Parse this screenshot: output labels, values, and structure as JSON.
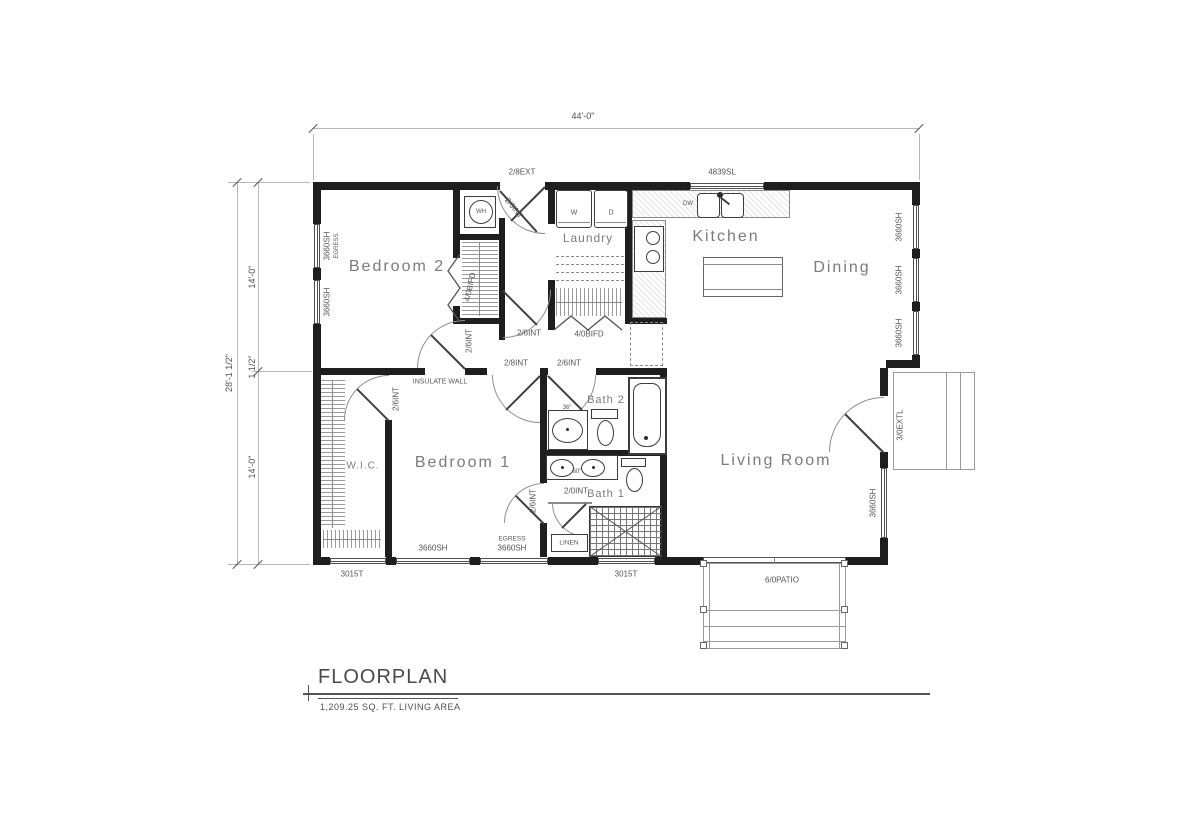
{
  "title_block": {
    "title": "FLOORPLAN",
    "subtitle": "1,209.25 SQ. FT. LIVING AREA"
  },
  "dimensions": {
    "overall_width": "44'-0\"",
    "overall_depth": "28'-1 1/2\"",
    "upper_depth": "14'-0\"",
    "wall_thickness": "1 1/2\"",
    "lower_depth": "14'-0\""
  },
  "rooms": {
    "bedroom2": "Bedroom 2",
    "bedroom1": "Bedroom 1",
    "wic": "W.I.C.",
    "laundry": "Laundry",
    "kitchen": "Kitchen",
    "dining": "Dining",
    "living": "Living Room",
    "bath1": "Bath 1",
    "bath2": "Bath 2"
  },
  "fixtures": {
    "washer": "W",
    "dryer": "D",
    "water_heater": "WH",
    "dishwasher": "DW",
    "linen": "LINEN",
    "bath2_vanity_width": "36\"",
    "bath1_vanity_width": "60\""
  },
  "annotations": [
    {
      "t": "2/8EXT",
      "x": 522,
      "y": 172
    },
    {
      "t": "4839SL",
      "x": 722,
      "y": 172
    },
    {
      "t": "2/6INT",
      "x": 514,
      "y": 208,
      "r": 52
    },
    {
      "t": "3660SH",
      "x": 327,
      "y": 246,
      "r": -90
    },
    {
      "t": "EGRESS",
      "x": 337,
      "y": 246,
      "r": -90,
      "s": 6
    },
    {
      "t": "3660SH",
      "x": 327,
      "y": 302,
      "r": -90
    },
    {
      "t": "4/0BIFD",
      "x": 470,
      "y": 287,
      "r": -78
    },
    {
      "t": "2/6INT",
      "x": 469,
      "y": 341,
      "r": -90
    },
    {
      "t": "2/6INT",
      "x": 529,
      "y": 333
    },
    {
      "t": "4/0BIFD",
      "x": 589,
      "y": 334
    },
    {
      "t": "2/8INT",
      "x": 516,
      "y": 363
    },
    {
      "t": "2/6INT",
      "x": 569,
      "y": 363
    },
    {
      "t": "INSULATE WALL",
      "x": 440,
      "y": 382,
      "s": 7
    },
    {
      "t": "2/6INT",
      "x": 396,
      "y": 399,
      "r": -90
    },
    {
      "t": "2/6INT",
      "x": 533,
      "y": 501,
      "r": -90
    },
    {
      "t": "2/0INT",
      "x": 576,
      "y": 491
    },
    {
      "t": "EGRESS",
      "x": 512,
      "y": 539,
      "s": 6.5
    },
    {
      "t": "3660SH",
      "x": 512,
      "y": 548
    },
    {
      "t": "3660SH",
      "x": 433,
      "y": 548
    },
    {
      "t": "3015T",
      "x": 352,
      "y": 574
    },
    {
      "t": "3015T",
      "x": 626,
      "y": 574
    },
    {
      "t": "6/0PATIO",
      "x": 782,
      "y": 580
    },
    {
      "t": "3660SH",
      "x": 873,
      "y": 503,
      "r": -90
    },
    {
      "t": "3/0EXTL",
      "x": 900,
      "y": 425,
      "r": -90
    },
    {
      "t": "3660SH",
      "x": 899,
      "y": 227,
      "r": -90
    },
    {
      "t": "3660SH",
      "x": 899,
      "y": 280,
      "r": -90
    },
    {
      "t": "3660SH",
      "x": 899,
      "y": 333,
      "r": -90
    }
  ]
}
